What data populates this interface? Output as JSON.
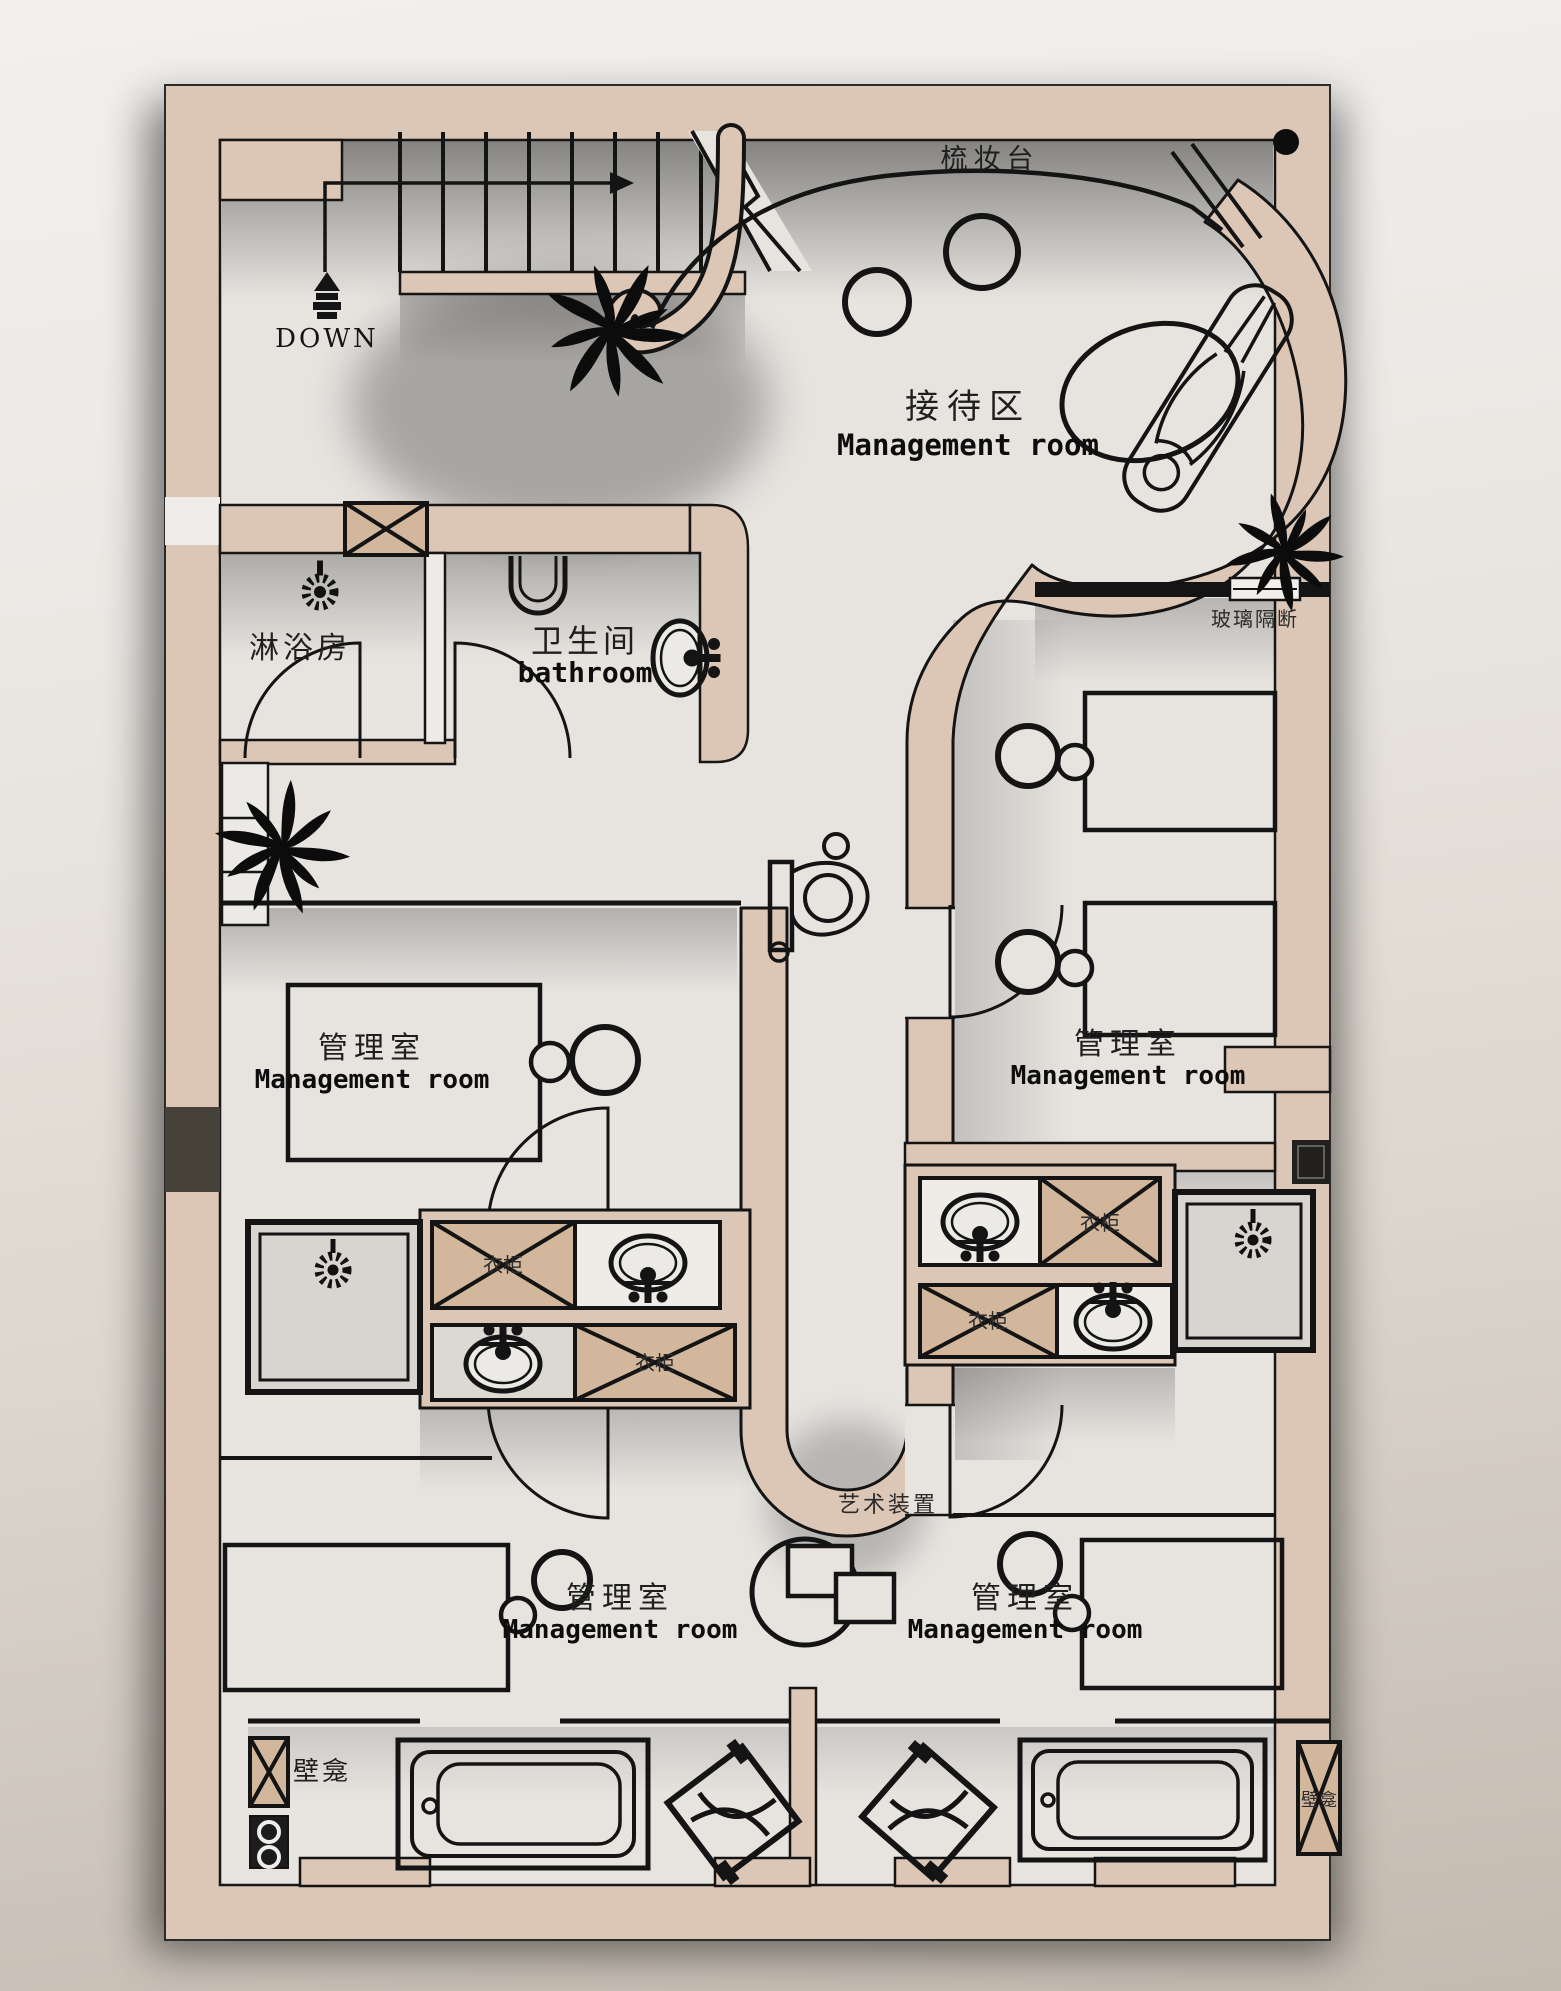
{
  "colors": {
    "wall": "#dcc6b6",
    "cabinet": "#d2b79d",
    "floor": "#e7e4e0",
    "line": "#141414",
    "background_top": "#f2f0ee",
    "background_bottom": "#c3bab0"
  },
  "labels": {
    "dressing_table": "梳妆台",
    "down": "DOWN",
    "shower_room": "淋浴房",
    "bathroom": {
      "zh": "卫生间",
      "en": "bathroom"
    },
    "reception": {
      "zh": "接待区",
      "en": "Management room"
    },
    "glass_partition": "玻璃隔断",
    "management_mid_left": {
      "zh": "管理室",
      "en": "Management room"
    },
    "management_mid_right": {
      "zh": "管理室",
      "en": "Management room"
    },
    "management_bottom_left": {
      "zh": "管理室",
      "en": "Management room"
    },
    "management_bottom_right": {
      "zh": "管理室",
      "en": "Management room"
    },
    "art_installation": "艺术装置",
    "wardrobe": "衣柜",
    "niche": "壁龛"
  }
}
